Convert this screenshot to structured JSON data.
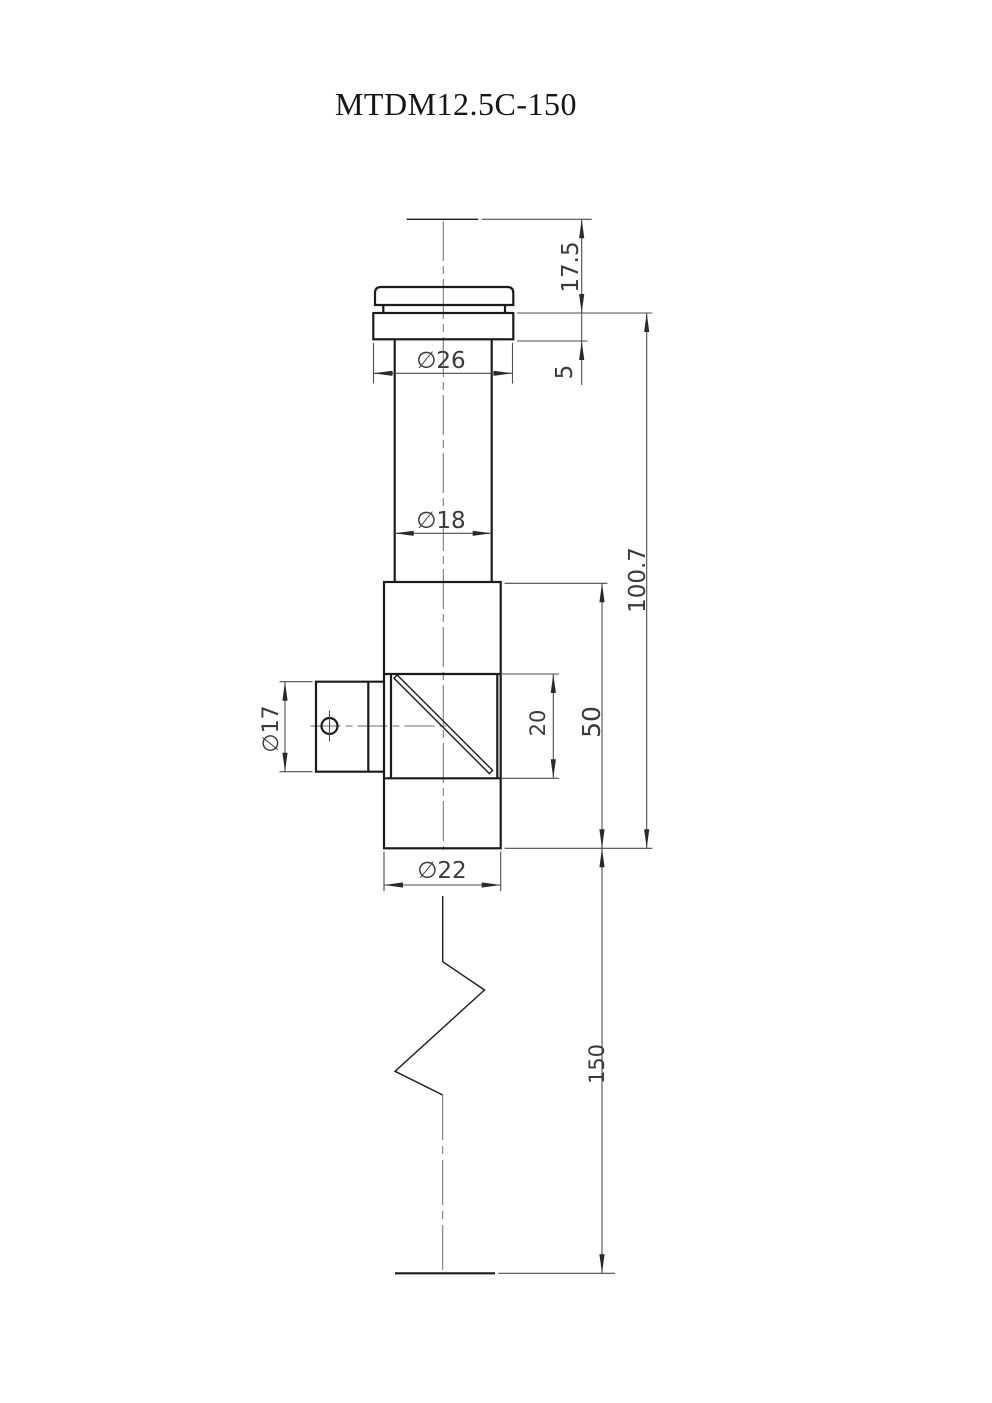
{
  "title": "MTDM12.5C-150",
  "drawing_type": "engineering-dimension-drawing",
  "dimensions": {
    "eyepoint_to_flange": "17.5",
    "flange_thickness": "5",
    "flange_diameter": "∅26",
    "eyepiece_tube_diameter": "∅18",
    "upper_assembly_length": "100.7",
    "prism_housing_length": "50",
    "window_length": "20",
    "side_port_diameter": "∅17",
    "housing_diameter": "∅22",
    "probe_length": "150"
  },
  "colors": {
    "ink": "#1b1b1b",
    "thin_line": "#4d4d4d",
    "centerline": "#6e6e6e",
    "background": "#ffffff"
  }
}
